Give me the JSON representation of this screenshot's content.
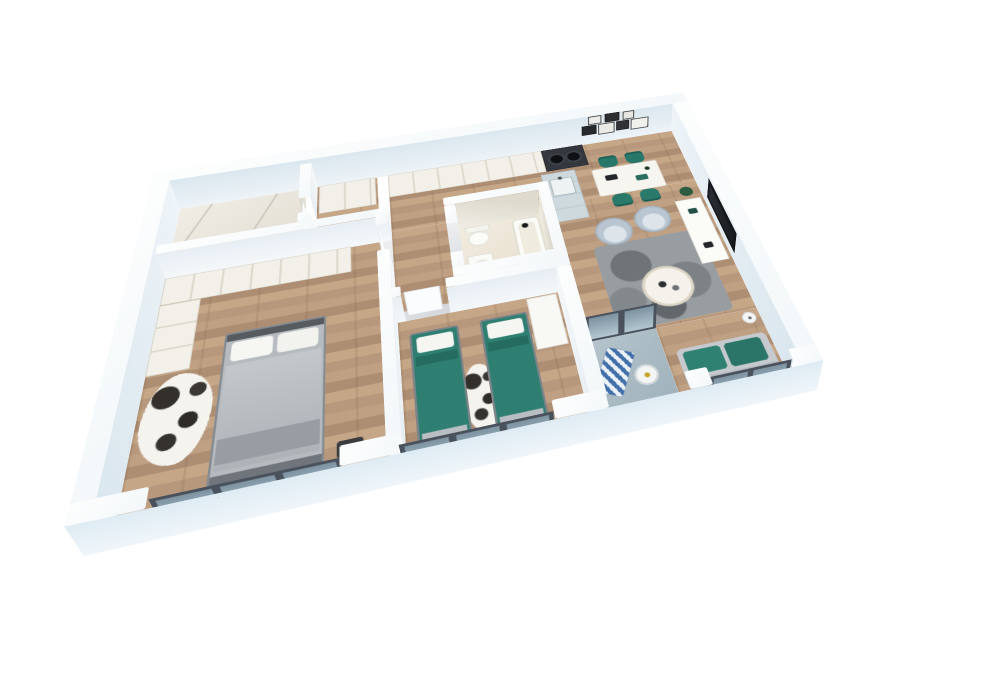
{
  "scene": {
    "description": "3D cutaway perspective render of a two-bedroom apartment floor plan floating on a white background",
    "style": "white chunky walls with pale-blue faces, oak plank floors, teal accent furniture, glass balustrades on the window side",
    "palette": {
      "background": "#ffffff",
      "wall_top": "#fbfdfe",
      "wall_inner_face": "#e4edf4",
      "wall_outer_face": "#e9f2f8",
      "wood_floor": "#bb9d81",
      "marble_floor": "#e9e5da",
      "bathroom_floor": "#eee7d8",
      "balcony_floor": "#a9bac3",
      "accent_teal": "#2a7a6c",
      "sofa_gray": "#c6cacf",
      "armchair_blue_gray": "#b9c6d2",
      "rug_gray": "#989da2",
      "window_frame": "#49525c",
      "glass": "#c1dbe9",
      "tv_black": "#141619",
      "cabinet_cream": "#f2f0e9",
      "island_blue": "#ccd9dd",
      "cowhide": "#f5f3ee"
    },
    "rooms": [
      {
        "name": "bathroom-1",
        "floor": "marble",
        "items": [
          "open-door"
        ]
      },
      {
        "name": "hallway",
        "floor": "wood",
        "items": [
          "wardrobe-cabinet",
          "open-doors"
        ]
      },
      {
        "name": "kitchen",
        "floor": "wood",
        "items": [
          "cream-cabinet-run",
          "dark-appliance-column",
          "blue-island-with-sink"
        ]
      },
      {
        "name": "dining-area",
        "floor": "wood",
        "items": [
          "white-dining-table",
          "four-teal-chairs",
          "gallery-wall-of-framed-art"
        ]
      },
      {
        "name": "living-room",
        "floor": "wood",
        "items": [
          "wall-mounted-tv",
          "tv-console",
          "two-armchairs",
          "round-coffee-table",
          "gray-mottled-rug",
          "teal-sofa",
          "floor-lamp",
          "plant"
        ]
      },
      {
        "name": "bathroom-2",
        "floor": "stone",
        "items": [
          "bathtub-with-black-faucet",
          "toilet",
          "washbasin",
          "wood-vanity-stool"
        ]
      },
      {
        "name": "master-bedroom",
        "floor": "wood",
        "items": [
          "double-bed-gray-duvet",
          "l-shaped-wardrobe",
          "cowhide-rug",
          "dark-bench"
        ]
      },
      {
        "name": "bedroom-2",
        "floor": "wood",
        "items": [
          "single-bed-teal",
          "single-bed-teal",
          "cowhide-rug",
          "wardrobe"
        ]
      },
      {
        "name": "balcony",
        "floor": "concrete",
        "items": [
          "striped-deck-chair",
          "round-side-table",
          "glass-balustrade"
        ]
      }
    ],
    "windows": [
      "master-bedroom-window",
      "bedroom-2-window",
      "balcony-opening",
      "living-room-window"
    ],
    "camera": {
      "view": "elevated three-quarter perspective, rotated ~14 degrees, tilted ~55 degrees"
    }
  }
}
